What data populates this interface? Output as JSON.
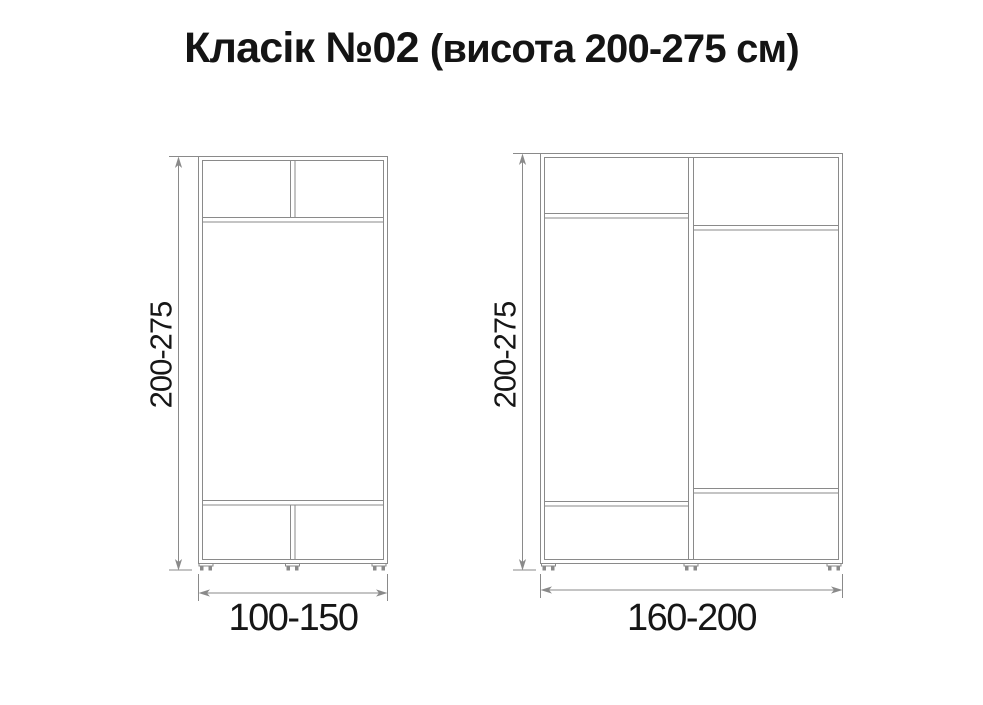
{
  "title": {
    "main": "Класік №02",
    "sub": "(висота 200-275 см)"
  },
  "wardrobes": {
    "left": {
      "height_label": "200-275",
      "width_label": "100-150"
    },
    "right": {
      "height_label": "200-275",
      "width_label": "160-200"
    }
  },
  "colors": {
    "line": "#8a8a8a",
    "text": "#141414",
    "background": "#ffffff"
  }
}
